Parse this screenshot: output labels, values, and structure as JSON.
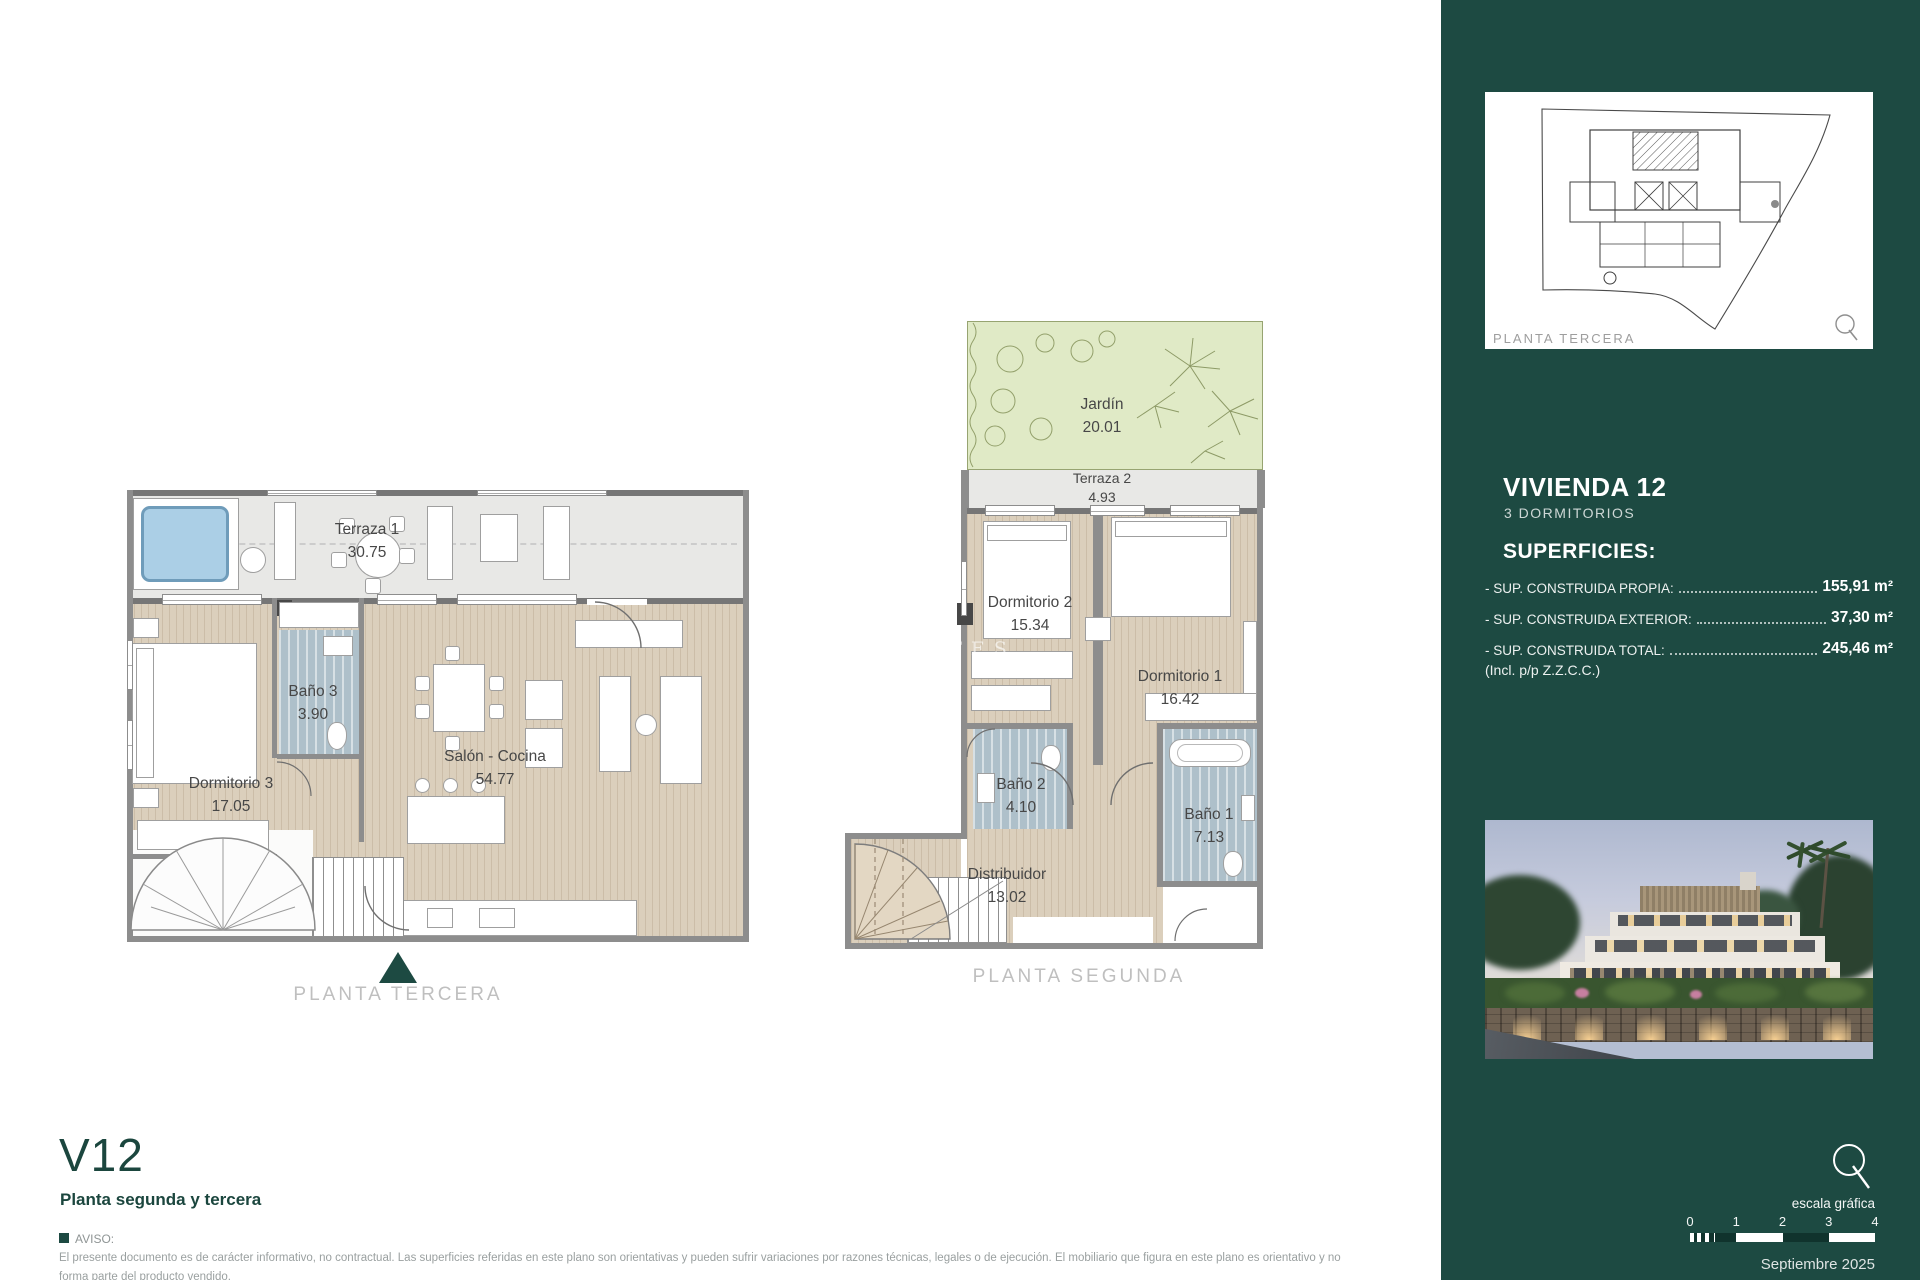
{
  "colors": {
    "sidebar_green": "#1d4a42",
    "accent_teal": "#1d4a42",
    "wood_floor": "#dbcfbc",
    "bath_blue": "#aec0ca",
    "garden_green": "#e0eac6",
    "terrace_grey": "#e8e8e6",
    "pool_blue": "#abcfe6"
  },
  "watermark": {
    "large": "TA",
    "mid": "Q",
    "small": "ESTATES"
  },
  "left_plan": {
    "label": "PLANTA TERCERA",
    "rooms": [
      {
        "name": "Terraza 1",
        "area": "30.75"
      },
      {
        "name": "Dormitorio 3",
        "area": "17.05"
      },
      {
        "name": "Baño 3",
        "area": "3.90"
      },
      {
        "name": "Salón - Cocina",
        "area": "54.77"
      }
    ]
  },
  "right_plan": {
    "label": "PLANTA SEGUNDA",
    "rooms": [
      {
        "name": "Jardín",
        "area": "20.01"
      },
      {
        "name": "Terraza 2",
        "area": "4.93"
      },
      {
        "name": "Dormitorio 2",
        "area": "15.34"
      },
      {
        "name": "Dormitorio 1",
        "area": "16.42"
      },
      {
        "name": "Baño 2",
        "area": "4.10"
      },
      {
        "name": "Baño 1",
        "area": "7.13"
      },
      {
        "name": "Distribuidor",
        "area": "13.02"
      }
    ]
  },
  "footer": {
    "unit_code": "V12",
    "subtitle": "Planta segunda y tercera",
    "aviso_label": "AVISO:",
    "disclaimer_line1": "El presente documento es de carácter informativo, no contractual. Las superficies referidas en este plano son orientativas y pueden sufrir variaciones por razones técnicas, legales o de ejecución. El mobiliario que figura en este plano es orientativo y no",
    "disclaimer_line2": "forma parte del producto vendido."
  },
  "sidebar": {
    "thumbnail_label": "PLANTA TERCERA",
    "title": "VIVIENDA 12",
    "subtitle": "3 DORMITORIOS",
    "superficies_heading": "SUPERFICIES:",
    "superficies": [
      {
        "label": "- SUP. CONSTRUIDA PROPIA:",
        "value": "155,91 m²"
      },
      {
        "label": "- SUP. CONSTRUIDA EXTERIOR:",
        "value": "37,30 m²"
      },
      {
        "label": "- SUP. CONSTRUIDA TOTAL:",
        "value": "245,46 m²"
      }
    ],
    "superficies_note": "(Incl. p/p Z.Z.C.C.)",
    "scale_label": "escala gráfica",
    "scale_ticks": [
      "0",
      "1",
      "2",
      "3",
      "4"
    ],
    "date": "Septiembre 2025"
  }
}
